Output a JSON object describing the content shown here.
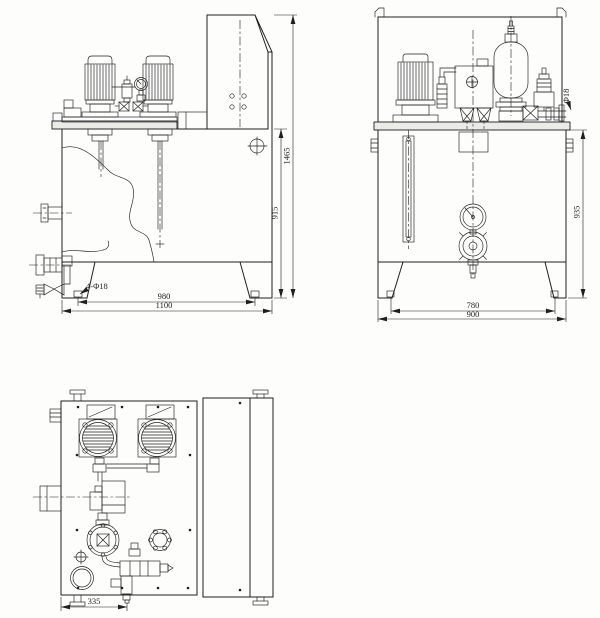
{
  "colors": {
    "line": "#1f1f1f",
    "paper": "#fdfdfc"
  },
  "dims": {
    "front": {
      "total_height": "1465",
      "tank_height": "915",
      "foot_hole_span": "980",
      "overall_width": "1100",
      "foot_hole_callout": "4-Φ18"
    },
    "side": {
      "outlet_pipe": "Φ18",
      "tank_height": "935",
      "foot_hole_span": "780",
      "overall_width": "900"
    },
    "plan": {
      "valve_offset": "335"
    }
  }
}
